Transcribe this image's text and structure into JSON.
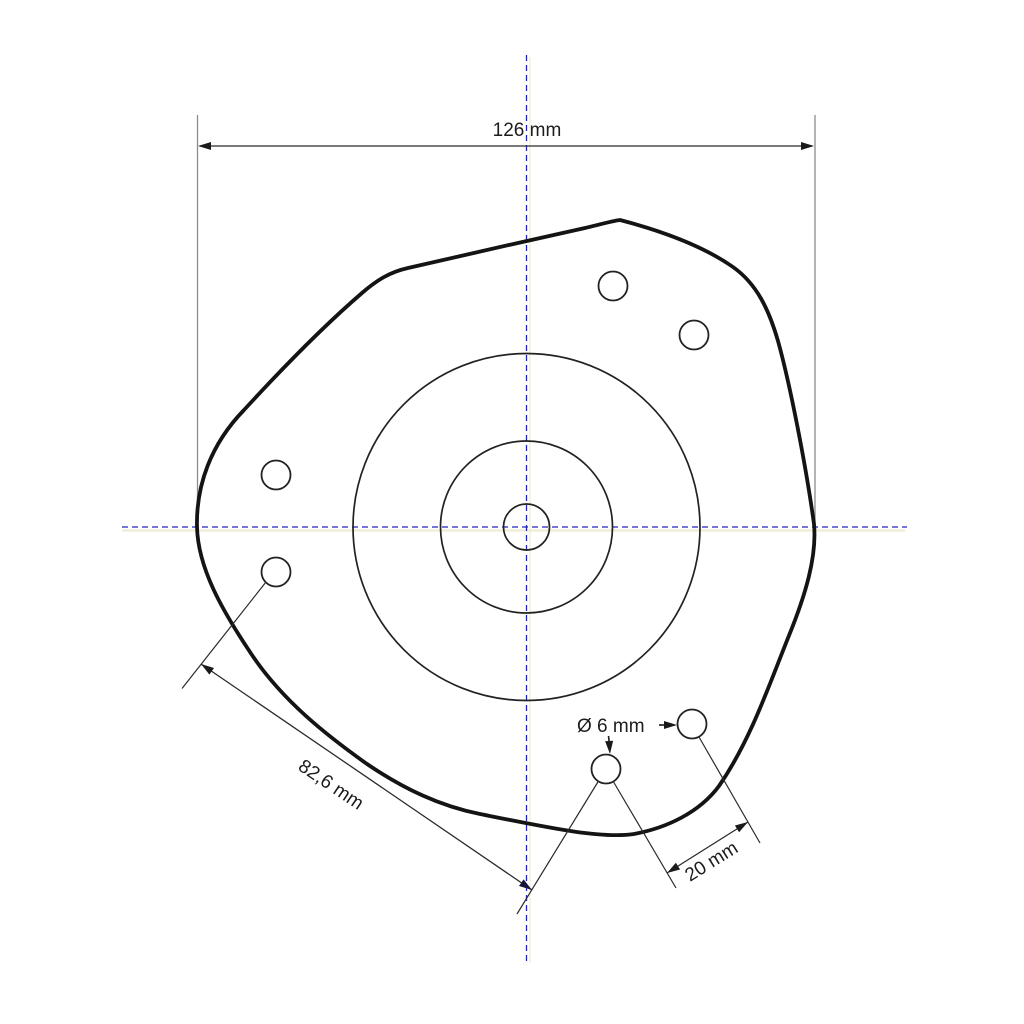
{
  "diagram": {
    "kind": "technical-drawing",
    "subject": "strut-mount-plate-top-view",
    "labels": {
      "overall_width": "126 mm",
      "diagonal_hole_spacing": "82,6 mm",
      "hole_diameter": "Ø 6 mm",
      "bottom_hole_spacing": "20 mm"
    },
    "colors": {
      "outline": "#141414",
      "thin_line": "#2b2b2b",
      "extension_gray": "#8c8c8c",
      "centerline_blue": "#2424bc",
      "centerline_ghost": "#ece5c6",
      "background": "#ffffff"
    },
    "features": {
      "small_holes_count": 6,
      "concentric_circles_count": 3
    }
  }
}
